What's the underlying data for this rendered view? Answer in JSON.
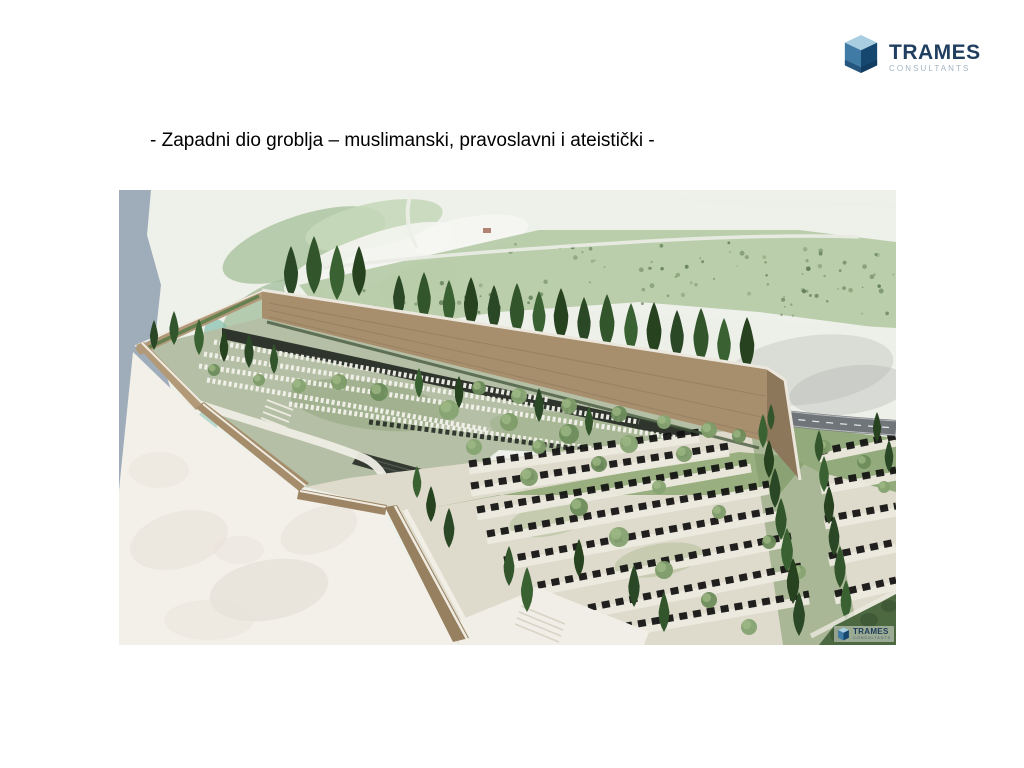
{
  "header": {
    "brand": "TRAMES",
    "brand_sub": "CONSULTANTS"
  },
  "caption": {
    "text": "- Zapadni dio groblja – muslimanski, pravoslavni i ateistički -"
  },
  "watermark": {
    "brand": "TRAMES",
    "brand_sub": "CONSULTANTS"
  },
  "logo_colors": {
    "cube_top": "#a9cee2",
    "cube_left": "#3f7ba5",
    "cube_right": "#16486f",
    "brand_text": "#203f60",
    "brand_sub_text": "#a4b5c3"
  },
  "palette": {
    "water": "#9fadbb",
    "terrain": "#eef0ea",
    "terrain_green": "#adc5a1",
    "scrub_band": "#b7cba9",
    "wall_face": "#a78e6d",
    "wall_corner": "#8d775b",
    "wall_coping": "#ece7dc",
    "plateau": "#b4bfa5",
    "slope_white": "#f2f0e9",
    "terrace": "#dedbcd",
    "grass": "#8da772",
    "road": "#707579",
    "road_line": "#ffffff",
    "dark_structure": "#2f352d",
    "headstone_white": "#f4f3ec",
    "tombstone_black": "#101010",
    "cypress": [
      "#2a4726",
      "#33552c",
      "#3a6132",
      "#27421f"
    ],
    "olive": [
      "#7d9b68",
      "#6d8c5b",
      "#86a371"
    ],
    "olive_hi": "#a3bc87",
    "speckle": [
      "#5d7a52",
      "#6d8a5e",
      "#7f9a6d",
      "#55724c"
    ]
  },
  "scene": {
    "speckle_count": 120,
    "speckle_rects": [
      [
        200,
        92,
        185,
        48
      ],
      [
        385,
        52,
        255,
        62
      ],
      [
        640,
        56,
        135,
        72
      ]
    ],
    "cypress_back": [
      [
        172,
        108,
        52
      ],
      [
        195,
        104,
        58
      ],
      [
        218,
        110,
        55
      ],
      [
        240,
        106,
        50
      ],
      [
        280,
        129,
        44
      ],
      [
        305,
        132,
        50
      ],
      [
        330,
        136,
        46
      ],
      [
        352,
        139,
        52
      ],
      [
        375,
        142,
        47
      ],
      [
        398,
        146,
        53
      ],
      [
        420,
        149,
        48
      ],
      [
        442,
        152,
        54
      ],
      [
        465,
        156,
        49
      ],
      [
        488,
        159,
        55
      ],
      [
        512,
        163,
        50
      ],
      [
        535,
        167,
        55
      ],
      [
        558,
        170,
        50
      ],
      [
        582,
        174,
        56
      ],
      [
        605,
        178,
        50
      ],
      [
        628,
        181,
        54
      ]
    ],
    "cypress_front": [
      [
        35,
        160,
        30
      ],
      [
        55,
        155,
        34
      ],
      [
        80,
        165,
        36
      ],
      [
        105,
        172,
        32
      ],
      [
        130,
        178,
        34
      ],
      [
        155,
        184,
        30
      ],
      [
        300,
        208,
        30
      ],
      [
        340,
        218,
        32
      ],
      [
        420,
        232,
        34
      ],
      [
        470,
        246,
        30
      ],
      [
        298,
        308,
        32
      ],
      [
        312,
        332,
        36
      ],
      [
        330,
        358,
        40
      ],
      [
        390,
        396,
        40
      ],
      [
        408,
        422,
        45
      ],
      [
        460,
        387,
        38
      ],
      [
        515,
        417,
        42
      ],
      [
        545,
        442,
        40
      ],
      [
        644,
        258,
        34
      ],
      [
        650,
        288,
        38
      ],
      [
        656,
        318,
        40
      ],
      [
        662,
        350,
        42
      ],
      [
        668,
        382,
        44
      ],
      [
        674,
        414,
        46
      ],
      [
        680,
        446,
        44
      ],
      [
        700,
        272,
        32
      ],
      [
        705,
        302,
        36
      ],
      [
        710,
        334,
        38
      ],
      [
        715,
        366,
        40
      ],
      [
        721,
        398,
        42
      ],
      [
        727,
        430,
        40
      ],
      [
        758,
        252,
        30
      ],
      [
        770,
        282,
        32
      ],
      [
        652,
        240,
        26
      ]
    ],
    "olives": [
      [
        220,
        192,
        8
      ],
      [
        260,
        202,
        9
      ],
      [
        330,
        220,
        10
      ],
      [
        390,
        232,
        9
      ],
      [
        450,
        244,
        10
      ],
      [
        510,
        254,
        9
      ],
      [
        565,
        264,
        8
      ],
      [
        360,
        198,
        7
      ],
      [
        400,
        206,
        8
      ],
      [
        450,
        216,
        8
      ],
      [
        500,
        224,
        8
      ],
      [
        545,
        232,
        7
      ],
      [
        590,
        240,
        8
      ],
      [
        620,
        246,
        7
      ],
      [
        355,
        257,
        8
      ],
      [
        410,
        287,
        9
      ],
      [
        460,
        317,
        9
      ],
      [
        500,
        347,
        10
      ],
      [
        545,
        380,
        9
      ],
      [
        590,
        410,
        8
      ],
      [
        630,
        437,
        8
      ],
      [
        420,
        257,
        7
      ],
      [
        480,
        274,
        8
      ],
      [
        540,
        297,
        7
      ],
      [
        600,
        322,
        7
      ],
      [
        650,
        352,
        7
      ],
      [
        680,
        382,
        7
      ],
      [
        705,
        257,
        7
      ],
      [
        745,
        272,
        7
      ],
      [
        765,
        297,
        6
      ],
      [
        720,
        442,
        8
      ],
      [
        755,
        427,
        7
      ],
      [
        180,
        196,
        7
      ],
      [
        140,
        190,
        6
      ],
      [
        95,
        180,
        6
      ]
    ],
    "rows_upper": [
      {
        "p": [
          95,
          152,
          430,
          210
        ],
        "t": "w"
      },
      {
        "p": [
          85,
          164,
          520,
          232
        ],
        "t": "w"
      },
      {
        "p": [
          80,
          176,
          600,
          254
        ],
        "t": "w"
      },
      {
        "p": [
          88,
          190,
          370,
          240
        ],
        "t": "w"
      },
      {
        "p": [
          170,
          214,
          620,
          280
        ],
        "t": "w"
      },
      {
        "p": [
          250,
          232,
          560,
          272
        ],
        "t": "d"
      }
    ],
    "rows_lower": [
      {
        "p": [
          350,
          280,
          580,
          248
        ]
      },
      {
        "p": [
          352,
          302,
          610,
          262
        ]
      },
      {
        "p": [
          358,
          326,
          632,
          278
        ]
      },
      {
        "p": [
          368,
          350,
          650,
          300
        ]
      },
      {
        "p": [
          385,
          376,
          662,
          325
        ]
      },
      {
        "p": [
          405,
          404,
          672,
          352
        ]
      },
      {
        "p": [
          428,
          432,
          682,
          382
        ]
      },
      {
        "p": [
          450,
          452,
          690,
          410
        ]
      },
      {
        "p": [
          700,
          268,
          777,
          252
        ]
      },
      {
        "p": [
          702,
          300,
          777,
          286
        ]
      },
      {
        "p": [
          706,
          335,
          777,
          322
        ]
      },
      {
        "p": [
          710,
          372,
          777,
          358
        ]
      },
      {
        "p": [
          716,
          410,
          777,
          396
        ]
      },
      {
        "p": [
          722,
          445,
          760,
          436
        ]
      }
    ]
  }
}
